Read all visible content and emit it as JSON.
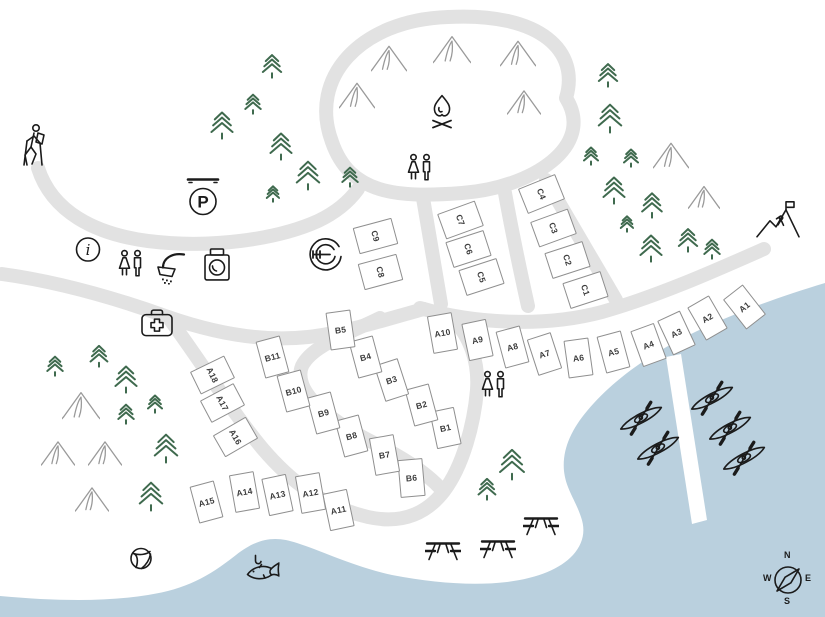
{
  "canvas": {
    "width": 825,
    "height": 617
  },
  "colors": {
    "water": "#bad0de",
    "road": "#e2e2e2",
    "tree": "#3f6a4e",
    "outline": "#1b1b1b",
    "tent_outline": "#9a9a9a",
    "site_border": "#8f8f8f",
    "site_label": "#3c3c3c",
    "land": "#ffffff"
  },
  "compass": {
    "n": "N",
    "e": "E",
    "s": "S",
    "w": "W"
  },
  "icon_letters": {
    "parking": "P",
    "information": "i"
  },
  "sites": [
    {
      "id": "A1",
      "x": 744,
      "y": 307,
      "rot": -38,
      "group": "A"
    },
    {
      "id": "A2",
      "x": 707,
      "y": 318,
      "rot": -30,
      "group": "A"
    },
    {
      "id": "A3",
      "x": 676,
      "y": 333,
      "rot": -25,
      "group": "A"
    },
    {
      "id": "A4",
      "x": 648,
      "y": 345,
      "rot": -20,
      "group": "A"
    },
    {
      "id": "A5",
      "x": 613,
      "y": 352,
      "rot": -15,
      "group": "A"
    },
    {
      "id": "A6",
      "x": 578,
      "y": 358,
      "rot": -8,
      "group": "A"
    },
    {
      "id": "A7",
      "x": 544,
      "y": 354,
      "rot": -18,
      "group": "A"
    },
    {
      "id": "A8",
      "x": 512,
      "y": 347,
      "rot": -15,
      "group": "A"
    },
    {
      "id": "A9",
      "x": 477,
      "y": 340,
      "rot": -12,
      "group": "A"
    },
    {
      "id": "A10",
      "x": 442,
      "y": 333,
      "rot": -10,
      "group": "A"
    },
    {
      "id": "A11",
      "x": 338,
      "y": 510,
      "rot": -12,
      "group": "A"
    },
    {
      "id": "A12",
      "x": 310,
      "y": 493,
      "rot": -10,
      "group": "A"
    },
    {
      "id": "A13",
      "x": 277,
      "y": 495,
      "rot": -12,
      "group": "A"
    },
    {
      "id": "A14",
      "x": 244,
      "y": 492,
      "rot": -10,
      "group": "A"
    },
    {
      "id": "A15",
      "x": 206,
      "y": 502,
      "rot": -15,
      "group": "A"
    },
    {
      "id": "A16",
      "x": 235,
      "y": 437,
      "rot": 60,
      "group": "A"
    },
    {
      "id": "A17",
      "x": 222,
      "y": 403,
      "rot": 62,
      "group": "A"
    },
    {
      "id": "A18",
      "x": 212,
      "y": 375,
      "rot": 64,
      "group": "A"
    },
    {
      "id": "B1",
      "x": 445,
      "y": 428,
      "rot": -12,
      "group": "B"
    },
    {
      "id": "B2",
      "x": 421,
      "y": 405,
      "rot": -15,
      "group": "B"
    },
    {
      "id": "B3",
      "x": 391,
      "y": 380,
      "rot": -18,
      "group": "B"
    },
    {
      "id": "B4",
      "x": 365,
      "y": 357,
      "rot": -15,
      "group": "B"
    },
    {
      "id": "B5",
      "x": 340,
      "y": 330,
      "rot": -8,
      "group": "B"
    },
    {
      "id": "B6",
      "x": 411,
      "y": 478,
      "rot": -5,
      "group": "B"
    },
    {
      "id": "B7",
      "x": 384,
      "y": 455,
      "rot": -10,
      "group": "B"
    },
    {
      "id": "B8",
      "x": 351,
      "y": 436,
      "rot": -15,
      "group": "B"
    },
    {
      "id": "B9",
      "x": 323,
      "y": 413,
      "rot": -15,
      "group": "B"
    },
    {
      "id": "B10",
      "x": 293,
      "y": 391,
      "rot": -15,
      "group": "B"
    },
    {
      "id": "B11",
      "x": 272,
      "y": 357,
      "rot": -15,
      "group": "B"
    },
    {
      "id": "C1",
      "x": 585,
      "y": 290,
      "rot": 72,
      "group": "C"
    },
    {
      "id": "C2",
      "x": 567,
      "y": 260,
      "rot": 72,
      "group": "C"
    },
    {
      "id": "C3",
      "x": 553,
      "y": 228,
      "rot": 70,
      "group": "C"
    },
    {
      "id": "C4",
      "x": 541,
      "y": 194,
      "rot": 68,
      "group": "C"
    },
    {
      "id": "C5",
      "x": 481,
      "y": 277,
      "rot": 72,
      "group": "C"
    },
    {
      "id": "C6",
      "x": 468,
      "y": 249,
      "rot": 72,
      "group": "C"
    },
    {
      "id": "C7",
      "x": 460,
      "y": 220,
      "rot": 70,
      "group": "C"
    },
    {
      "id": "C8",
      "x": 380,
      "y": 272,
      "rot": 75,
      "group": "C"
    },
    {
      "id": "C9",
      "x": 375,
      "y": 236,
      "rot": 75,
      "group": "C"
    }
  ],
  "trees": [
    [
      222,
      127,
      30
    ],
    [
      253,
      106,
      22
    ],
    [
      272,
      68,
      26
    ],
    [
      281,
      148,
      30
    ],
    [
      308,
      177,
      32
    ],
    [
      273,
      196,
      18
    ],
    [
      350,
      179,
      22
    ],
    [
      608,
      77,
      26
    ],
    [
      610,
      120,
      32
    ],
    [
      591,
      158,
      20
    ],
    [
      631,
      160,
      20
    ],
    [
      614,
      192,
      30
    ],
    [
      652,
      207,
      28
    ],
    [
      627,
      226,
      18
    ],
    [
      651,
      250,
      30
    ],
    [
      688,
      242,
      26
    ],
    [
      712,
      251,
      22
    ],
    [
      55,
      368,
      22
    ],
    [
      99,
      358,
      24
    ],
    [
      126,
      381,
      30
    ],
    [
      126,
      416,
      22
    ],
    [
      155,
      406,
      20
    ],
    [
      166,
      450,
      32
    ],
    [
      151,
      498,
      32
    ],
    [
      512,
      466,
      34
    ],
    [
      487,
      491,
      24
    ]
  ],
  "tents": [
    [
      389,
      60,
      36
    ],
    [
      452,
      51,
      38
    ],
    [
      518,
      55,
      36
    ],
    [
      357,
      97,
      36
    ],
    [
      524,
      104,
      34
    ],
    [
      671,
      157,
      36
    ],
    [
      704,
      199,
      32
    ],
    [
      81,
      407,
      38
    ],
    [
      58,
      455,
      34
    ],
    [
      105,
      455,
      34
    ],
    [
      92,
      501,
      34
    ]
  ],
  "kayaks": [
    [
      642,
      420
    ],
    [
      659,
      450
    ],
    [
      713,
      400
    ],
    [
      731,
      430
    ],
    [
      745,
      460
    ]
  ],
  "picnic_tables": [
    [
      443,
      553
    ],
    [
      498,
      551
    ],
    [
      541,
      528
    ]
  ],
  "facilities": [
    {
      "name": "hiking-trailhead",
      "x": 35,
      "y": 147,
      "s": 36
    },
    {
      "name": "parking",
      "x": 203,
      "y": 199,
      "s": 40
    },
    {
      "name": "information",
      "x": 88,
      "y": 252,
      "s": 27
    },
    {
      "name": "restrooms",
      "x": 131,
      "y": 267,
      "s": 30
    },
    {
      "name": "showers",
      "x": 172,
      "y": 270,
      "s": 34
    },
    {
      "name": "laundry",
      "x": 217,
      "y": 267,
      "s": 31
    },
    {
      "name": "first-aid",
      "x": 157,
      "y": 325,
      "s": 35
    },
    {
      "name": "food",
      "x": 324,
      "y": 257,
      "s": 38
    },
    {
      "name": "campfire",
      "x": 442,
      "y": 114,
      "s": 32
    },
    {
      "name": "restrooms",
      "x": 420,
      "y": 171,
      "s": 30
    },
    {
      "name": "restrooms",
      "x": 494,
      "y": 388,
      "s": 30
    },
    {
      "name": "climbing",
      "x": 778,
      "y": 222,
      "s": 46
    },
    {
      "name": "fishing",
      "x": 261,
      "y": 573,
      "s": 37
    },
    {
      "name": "ball-play",
      "x": 141,
      "y": 561,
      "s": 23
    }
  ]
}
